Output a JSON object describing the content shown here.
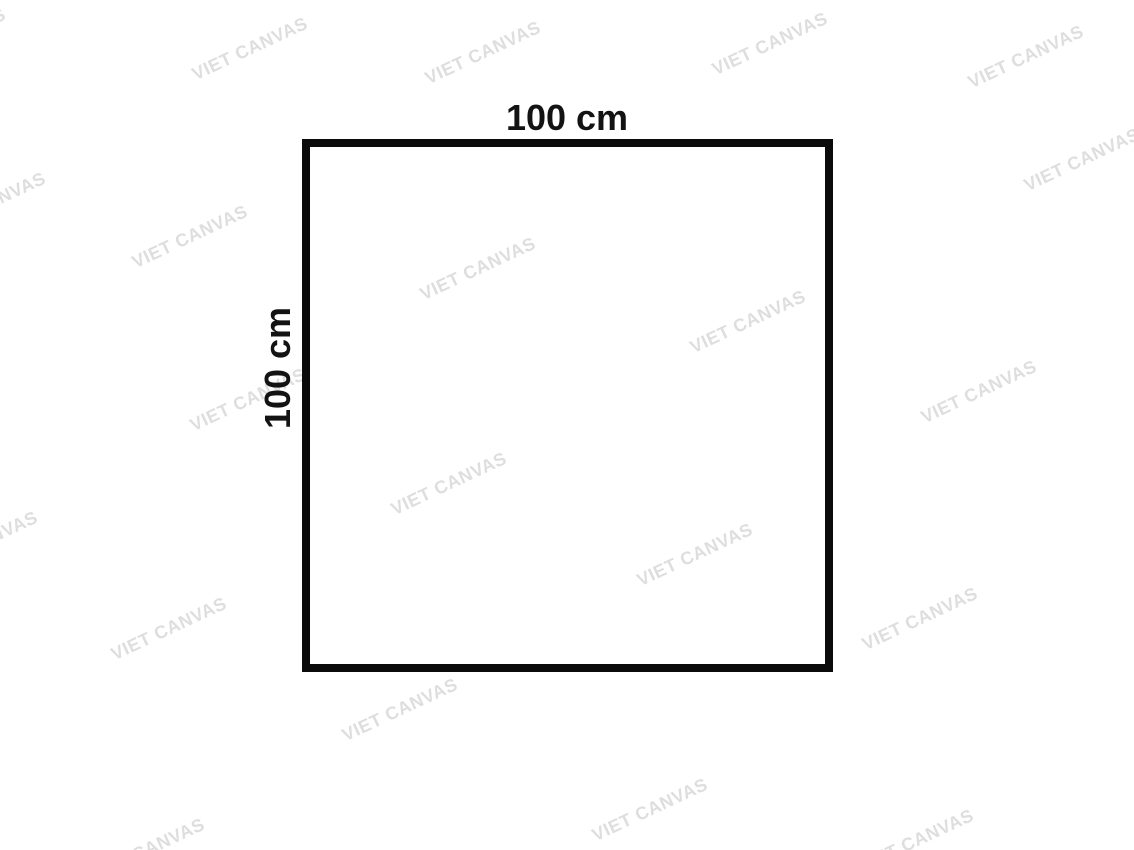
{
  "canvas": {
    "background": "#ffffff"
  },
  "diagram": {
    "top_label": "100 cm",
    "left_label": "100 cm",
    "label_color": "#131313",
    "square": {
      "border_color": "#0b0b0b",
      "border_px": 8
    }
  },
  "watermark": {
    "text": "VIET CANVAS",
    "color": "#dedede",
    "angle_deg": -25,
    "font_size_px": 18,
    "positions": [
      {
        "x": -52,
        "y": 40
      },
      {
        "x": 250,
        "y": 49
      },
      {
        "x": 483,
        "y": 53
      },
      {
        "x": 770,
        "y": 44
      },
      {
        "x": 1026,
        "y": 57
      },
      {
        "x": 1082,
        "y": 160
      },
      {
        "x": -12,
        "y": 204
      },
      {
        "x": 190,
        "y": 237
      },
      {
        "x": 478,
        "y": 269
      },
      {
        "x": 748,
        "y": 322
      },
      {
        "x": 979,
        "y": 392
      },
      {
        "x": 248,
        "y": 400
      },
      {
        "x": 449,
        "y": 484
      },
      {
        "x": 695,
        "y": 555
      },
      {
        "x": -20,
        "y": 543
      },
      {
        "x": 169,
        "y": 629
      },
      {
        "x": 920,
        "y": 619
      },
      {
        "x": 400,
        "y": 710
      },
      {
        "x": 650,
        "y": 810
      },
      {
        "x": 916,
        "y": 841
      },
      {
        "x": 147,
        "y": 850
      }
    ]
  }
}
